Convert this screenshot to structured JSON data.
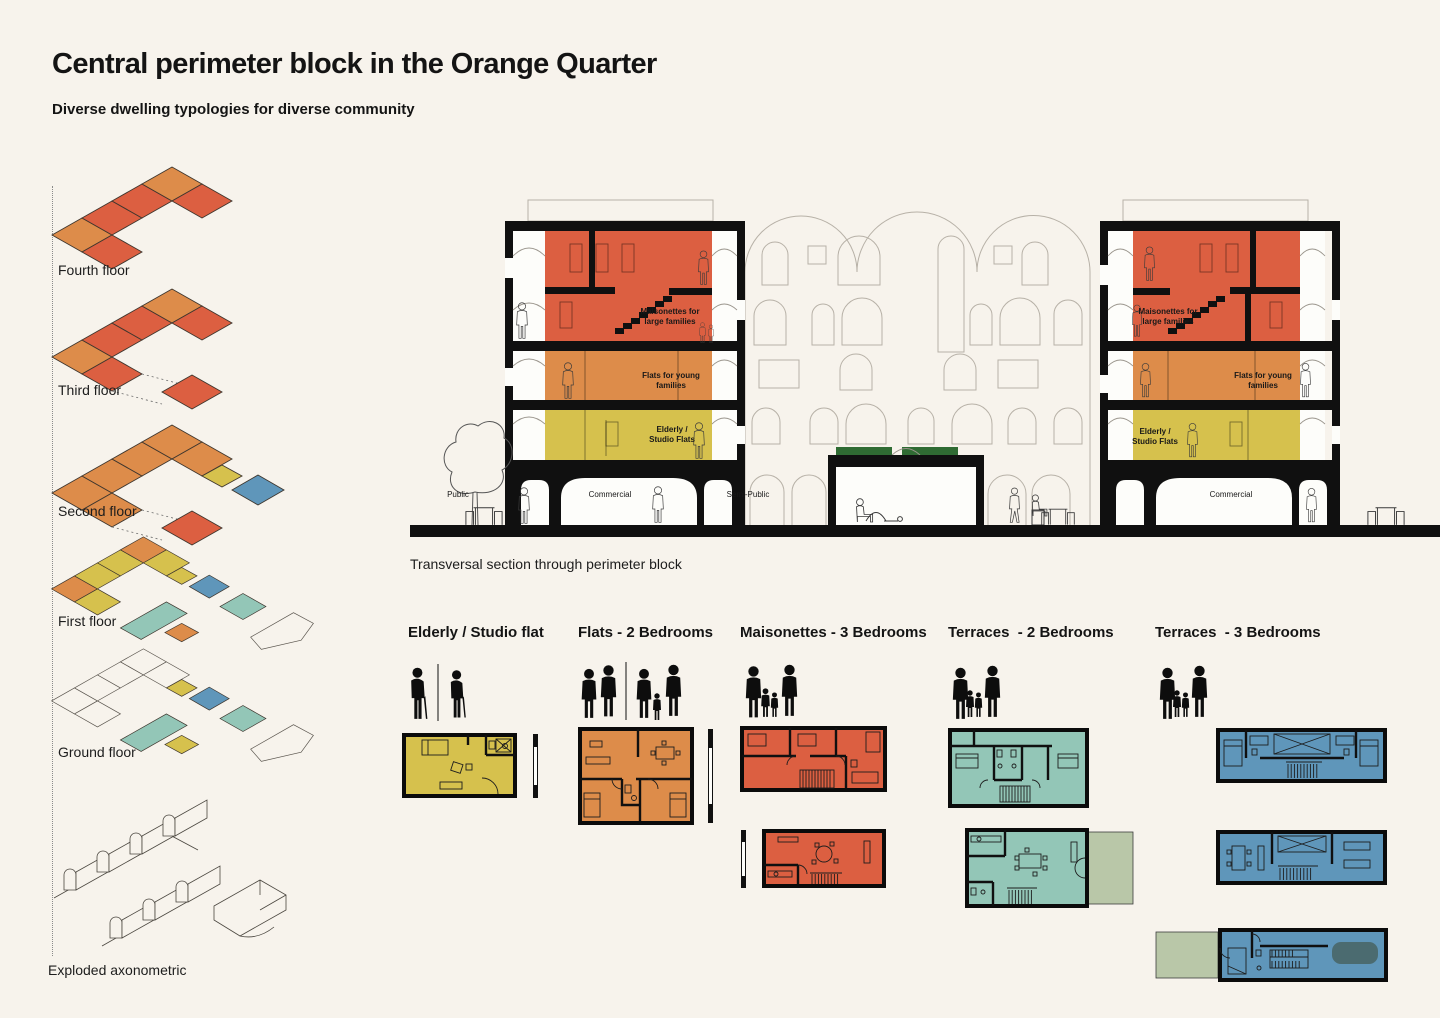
{
  "palette": {
    "bg": "#f7f3ec",
    "ink": "#141414",
    "line_gray": "#b7b1a7",
    "red": "#dc5f41",
    "orange": "#dd8c4a",
    "yellow": "#d6c14d",
    "teal": "#93c6b7",
    "blue": "#5f96ba",
    "sage": "#b9c7a8",
    "green": "#2f6b33",
    "car": "#4b6b70"
  },
  "header": {
    "title": "Central perimeter block in the Orange Quarter",
    "subtitle": "Diverse dwelling typologies for diverse community"
  },
  "axon": {
    "floors": [
      {
        "label": "Fourth floor"
      },
      {
        "label": "Third floor"
      },
      {
        "label": "Second floor"
      },
      {
        "label": "First floor"
      },
      {
        "label": "Ground floor"
      }
    ],
    "caption": "Exploded axonometric"
  },
  "section": {
    "caption": "Transversal section through perimeter block",
    "labels": {
      "maisonettes_1": "Maisonettes for",
      "maisonettes_2": "large families",
      "flats_1": "Flats for young",
      "flats_2": "families",
      "elderly_1": "Elderly /",
      "elderly_2": "Studio Flats",
      "public": "Public",
      "semi_public": "Semi-Public",
      "commercial": "Commercial"
    }
  },
  "typologies": [
    {
      "title": "Elderly / Studio flat"
    },
    {
      "title": "Flats - 2 Bedrooms"
    },
    {
      "title": "Maisonettes - 3 Bedrooms"
    },
    {
      "title": "Terraces  - 2 Bedrooms"
    },
    {
      "title": "Terraces  - 3 Bedrooms"
    }
  ]
}
